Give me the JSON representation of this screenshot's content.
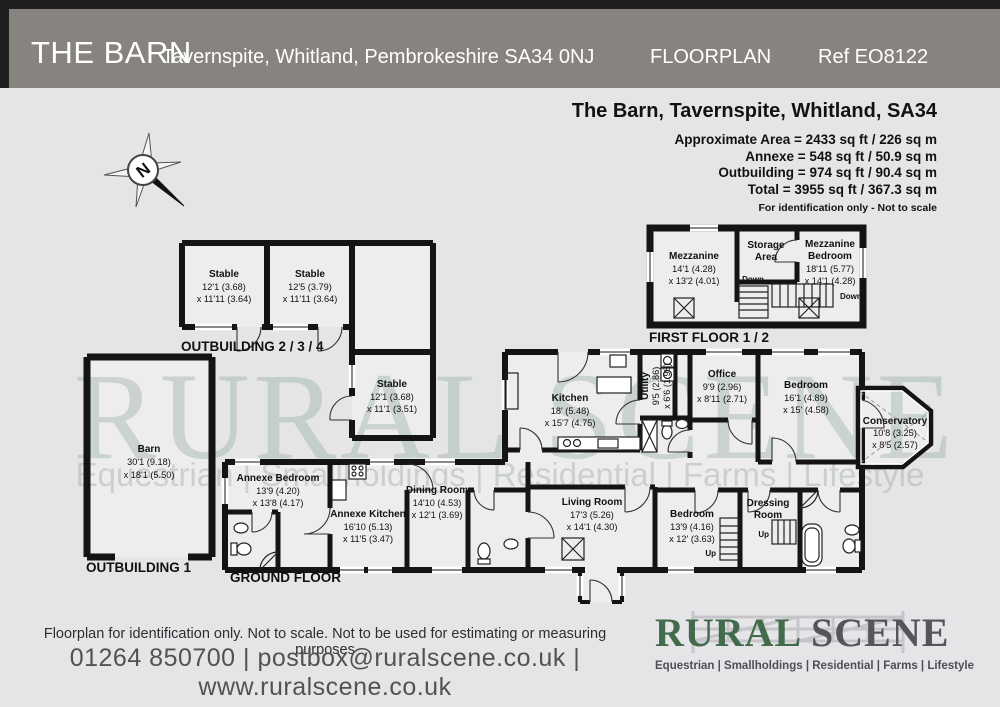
{
  "header": {
    "title": "THE BARN",
    "address": "Tavernspite, Whitland, Pembrokeshire SA34 0NJ",
    "doc_type": "FLOORPLAN",
    "ref": "Ref EO8122"
  },
  "summary": {
    "title": "The Barn, Tavernspite, Whitland, SA34",
    "lines": [
      "Approximate Area = 2433 sq ft / 226 sq m",
      "Annexe = 548 sq ft / 50.9 sq m",
      "Outbuilding = 974 sq ft / 90.4 sq m",
      "Total = 3955 sq ft / 367.3 sq m"
    ],
    "note": "For identification only - Not to scale"
  },
  "compass": {
    "north": "N"
  },
  "floor_labels": {
    "first_floor": "FIRST FLOOR 1 / 2",
    "outbuilding234": "OUTBUILDING 2 / 3 / 4",
    "outbuilding1": "OUTBUILDING 1",
    "ground_floor": "GROUND FLOOR"
  },
  "rooms": {
    "mezzanine": {
      "name": "Mezzanine",
      "dim1": "14'1 (4.28)",
      "dim2": "x 13'2 (4.01)"
    },
    "storage": {
      "name1": "Storage",
      "name2": "Area"
    },
    "mezzanine_bedroom": {
      "name1": "Mezzanine",
      "name2": "Bedroom",
      "dim1": "18'11 (5.77)",
      "dim2": "x 14'1 (4.28)"
    },
    "stable1": {
      "name": "Stable",
      "dim1": "12'1 (3.68)",
      "dim2": "x 11'11 (3.64)"
    },
    "stable2": {
      "name": "Stable",
      "dim1": "12'5 (3.79)",
      "dim2": "x 11'11 (3.64)"
    },
    "stable3": {
      "name": "Stable",
      "dim1": "12'1 (3.68)",
      "dim2": "x 11'1 (3.51)"
    },
    "barn": {
      "name": "Barn",
      "dim1": "30'1 (9.18)",
      "dim2": "x 18'1 (5.50)"
    },
    "annexe_bedroom": {
      "name": "Annexe Bedroom",
      "dim1": "13'9 (4.20)",
      "dim2": "x 13'8 (4.17)"
    },
    "annexe_kitchen": {
      "name": "Annexe Kitchen",
      "dim1": "16'10 (5.13)",
      "dim2": "x 11'5 (3.47)"
    },
    "dining_room": {
      "name": "Dining Room",
      "dim1": "14'10 (4.53)",
      "dim2": "x 12'1 (3.69)"
    },
    "kitchen": {
      "name": "Kitchen",
      "dim1": "18' (5.48)",
      "dim2": "x 15'7 (4.75)"
    },
    "utility": {
      "name": "Utility",
      "dim1": "9'5 (2.86)",
      "dim2": "x 6'6 (1.98)"
    },
    "office": {
      "name": "Office",
      "dim1": "9'9 (2.96)",
      "dim2": "x 8'11 (2.71)"
    },
    "bedroom_main": {
      "name": "Bedroom",
      "dim1": "16'1 (4.89)",
      "dim2": "x 15' (4.58)"
    },
    "conservatory": {
      "name": "Conservatory",
      "dim1": "10'8 (3.25)",
      "dim2": "x 8'5 (2.57)"
    },
    "living_room": {
      "name": "Living Room",
      "dim1": "17'3 (5.26)",
      "dim2": "x 14'1 (4.30)"
    },
    "bedroom2": {
      "name": "Bedroom",
      "dim1": "13'9 (4.16)",
      "dim2": "x 12' (3.63)"
    },
    "dressing_room": {
      "name1": "Dressing",
      "name2": "Room"
    }
  },
  "stairs": {
    "down1": "Down",
    "down2": "Down",
    "up1": "Up",
    "up2": "Up"
  },
  "watermark": {
    "line1": "RURAL SCENE",
    "line2": "Equestrian | Smallholdings | Residential | Farms | Lifestyle"
  },
  "footer": {
    "disclaimer": "Floorplan for identification only. Not to scale. Not to be used for estimating or measuring purposes",
    "contact": "01264 850700 | postbox@ruralscene.co.uk | www.ruralscene.co.uk"
  },
  "logo": {
    "word1": "RURAL",
    "word2": " SCENE",
    "tagline": "Equestrian | Smallholdings | Residential | Farms | Lifestyle"
  },
  "colors": {
    "header_bg": "#87847f",
    "page_bg": "#e5e5e8",
    "wall": "#141414",
    "room_fill": "#ededef",
    "logo_green": "#416b4b",
    "logo_gray": "#55565a",
    "watermark": "#9bb1a2"
  }
}
